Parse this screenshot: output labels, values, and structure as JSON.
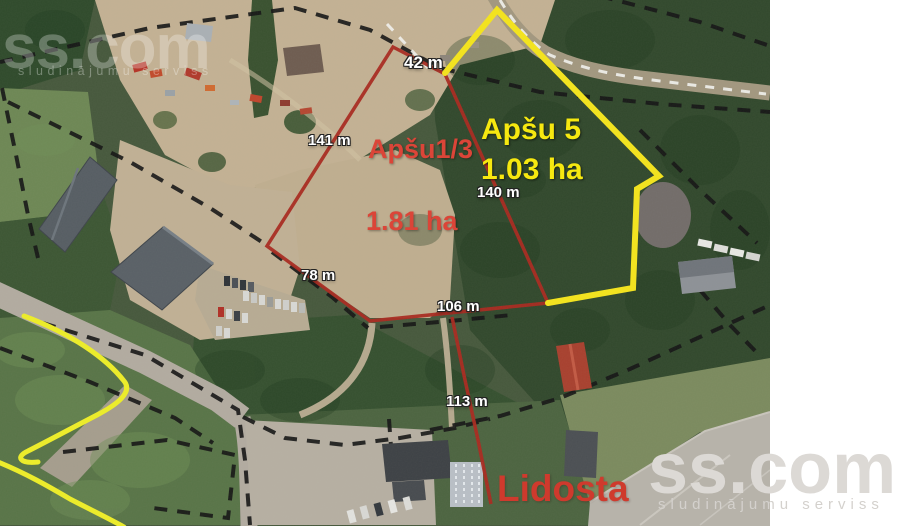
{
  "photo": {
    "description_labels": {
      "road_label": "Lidosta"
    },
    "plots": [
      {
        "name": "Apšu1/3",
        "area": "1.81 ha",
        "boundary_color": "#a92a20",
        "label_color": "#db4538"
      },
      {
        "name": "Apšu 5",
        "area": "1.03 ha",
        "boundary_color": "#f4e41c",
        "label_color": "#f6e810"
      }
    ],
    "measurements": [
      {
        "label": "42 m"
      },
      {
        "label": "141 m"
      },
      {
        "label": "140 m"
      },
      {
        "label": "78 m"
      },
      {
        "label": "106 m"
      },
      {
        "label": "113 m"
      }
    ],
    "cadastral_line_color": "#151515",
    "measurement_text_color": "#ffffff"
  },
  "watermark": {
    "brand": "ss.com",
    "tagline": "sludinājumu serviss"
  }
}
